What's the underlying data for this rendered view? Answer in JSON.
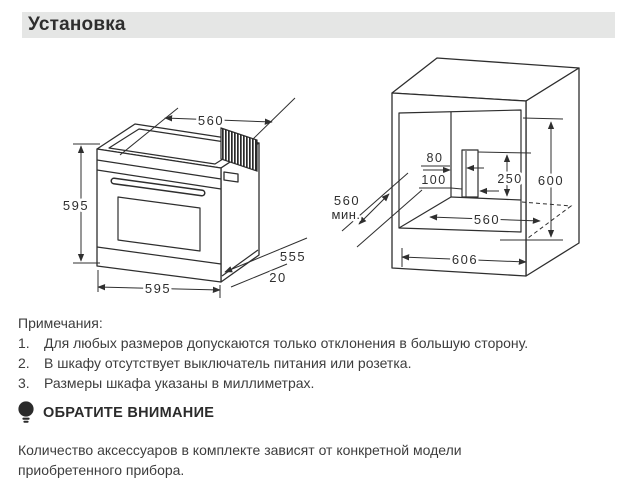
{
  "header": {
    "title": "Установка"
  },
  "oven": {
    "dim_top_width": "560",
    "dim_height": "595",
    "dim_bottom_width": "595",
    "dim_depth": "555",
    "dim_door_thickness": "20"
  },
  "cabinet": {
    "dim_hole_top_offset": "80",
    "dim_hole_side_offset": "100",
    "dim_hole_height": "250",
    "dim_niche_height": "600",
    "dim_depth_min": "560",
    "dim_depth_min_suffix": "мин.",
    "dim_niche_width": "560",
    "dim_outer_width": "606"
  },
  "notes": {
    "title": "Примечания:",
    "items": [
      {
        "num": "1.",
        "text": "Для любых размеров допускаются только отклонения в большую сторону."
      },
      {
        "num": "2.",
        "text": "В шкафу отсутствует выключатель питания или розетка."
      },
      {
        "num": "3.",
        "text": "Размеры шкафа указаны в миллиметрах."
      }
    ]
  },
  "attention": {
    "title": "ОБРАТИТЕ ВНИМАНИЕ",
    "body": "Количество аксессуаров в комплекте зависят от конкретной модели приобретенного прибора."
  }
}
